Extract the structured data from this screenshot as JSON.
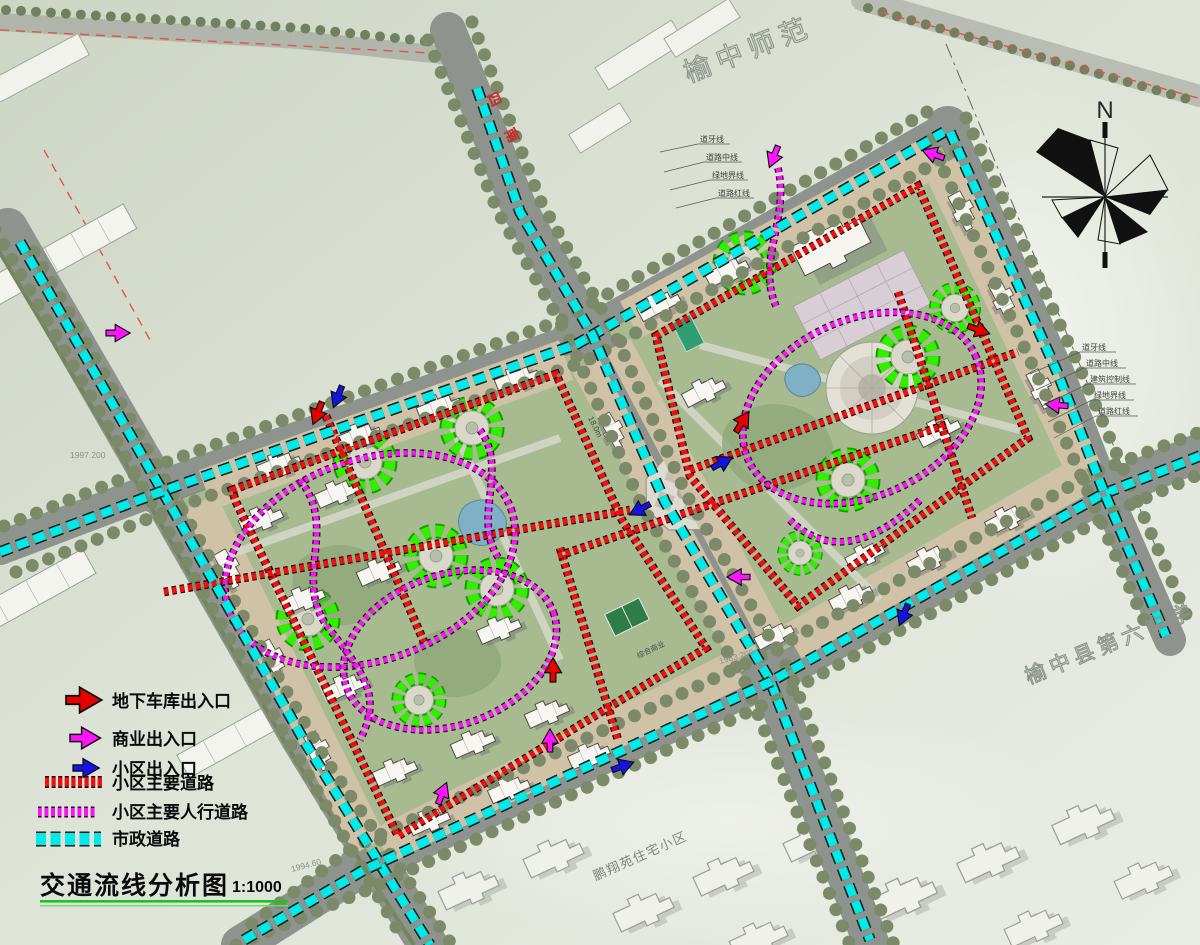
{
  "title": {
    "text": "交通流线分析图",
    "scale": "1:1000"
  },
  "legend": {
    "items": [
      {
        "label": "地下车库出入口",
        "type": "arrow",
        "color": "#e60000"
      },
      {
        "label": "商业出入口",
        "type": "arrow",
        "color": "#ff00ff"
      },
      {
        "label": "小区出入口",
        "type": "arrow",
        "color": "#1414e0"
      },
      {
        "label": "小区主要道路",
        "type": "dash",
        "color": "#e60000"
      },
      {
        "label": "小区主要人行道路",
        "type": "dash",
        "color": "#ff00ff"
      },
      {
        "label": "市政道路",
        "type": "dash",
        "color": "#00e6e6"
      }
    ]
  },
  "labels": {
    "school_top": "榆中师范",
    "school_right": "榆中县第六中学",
    "neighborhood_bottom": "鹏翔苑住宅小区",
    "commercial_center": "综合商业",
    "road_name_top": "四南",
    "dimension": "18.0m",
    "compass_n": "N"
  },
  "annotations": {
    "road_lines": [
      "道牙线",
      "道路中线",
      "建筑控制线",
      "绿地界线",
      "道路红线"
    ],
    "elevations": [
      "1997.200",
      "1994.60",
      "1983.200"
    ]
  },
  "colors": {
    "municipal_road_dash": "#00e6e6",
    "district_main_road_dash": "#e60000",
    "pedestrian_road_dash": "#ff00ff",
    "tree_ring_green": "#2ae000",
    "road_gray": "#8e938d",
    "block_tan": "#cfc2a6",
    "block_green": "#a7ba90",
    "background": "#dfe5da"
  }
}
